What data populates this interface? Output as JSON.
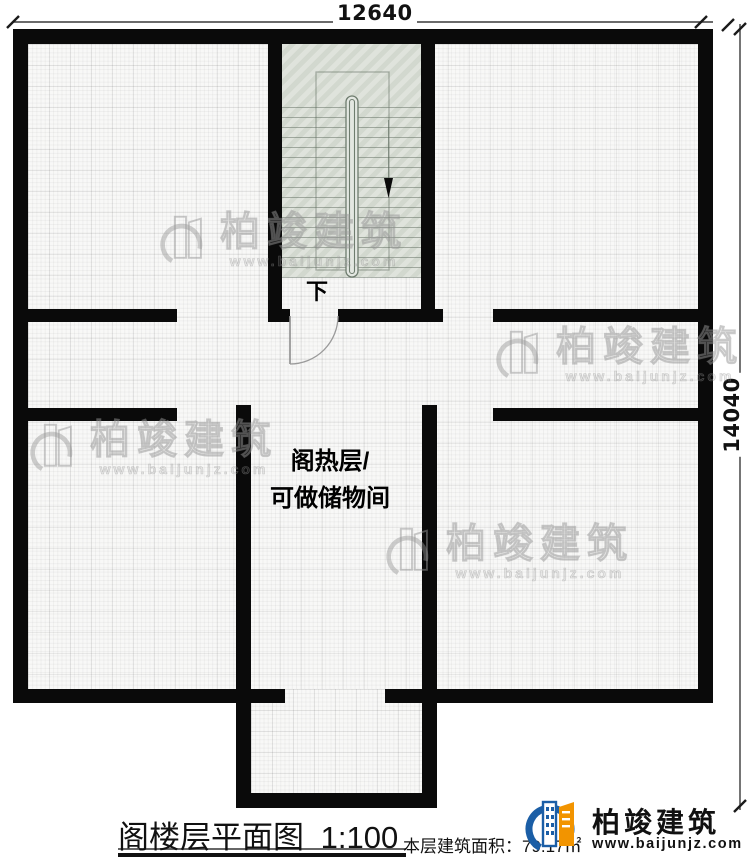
{
  "plan": {
    "dimension_top": "12640",
    "dimension_right": "14040",
    "stair_down_label": "下",
    "room_label_line1": "阁热层/",
    "room_label_line2": "可做储物间"
  },
  "watermark": {
    "brand": "柏竣建筑",
    "url": "www.baijunjz.com"
  },
  "footer": {
    "title": "阁楼层平面图",
    "scale": "1:100",
    "area_text": "本层建筑面积：",
    "area_value": "79.17㎡",
    "logo_brand": "柏竣建筑",
    "logo_url": "www.baijunjz.com"
  },
  "colors": {
    "wall": "#0a0a0a",
    "stair_fill": "#d8ddd4",
    "accent_blue": "#1b5ea6",
    "accent_orange": "#f29400"
  }
}
